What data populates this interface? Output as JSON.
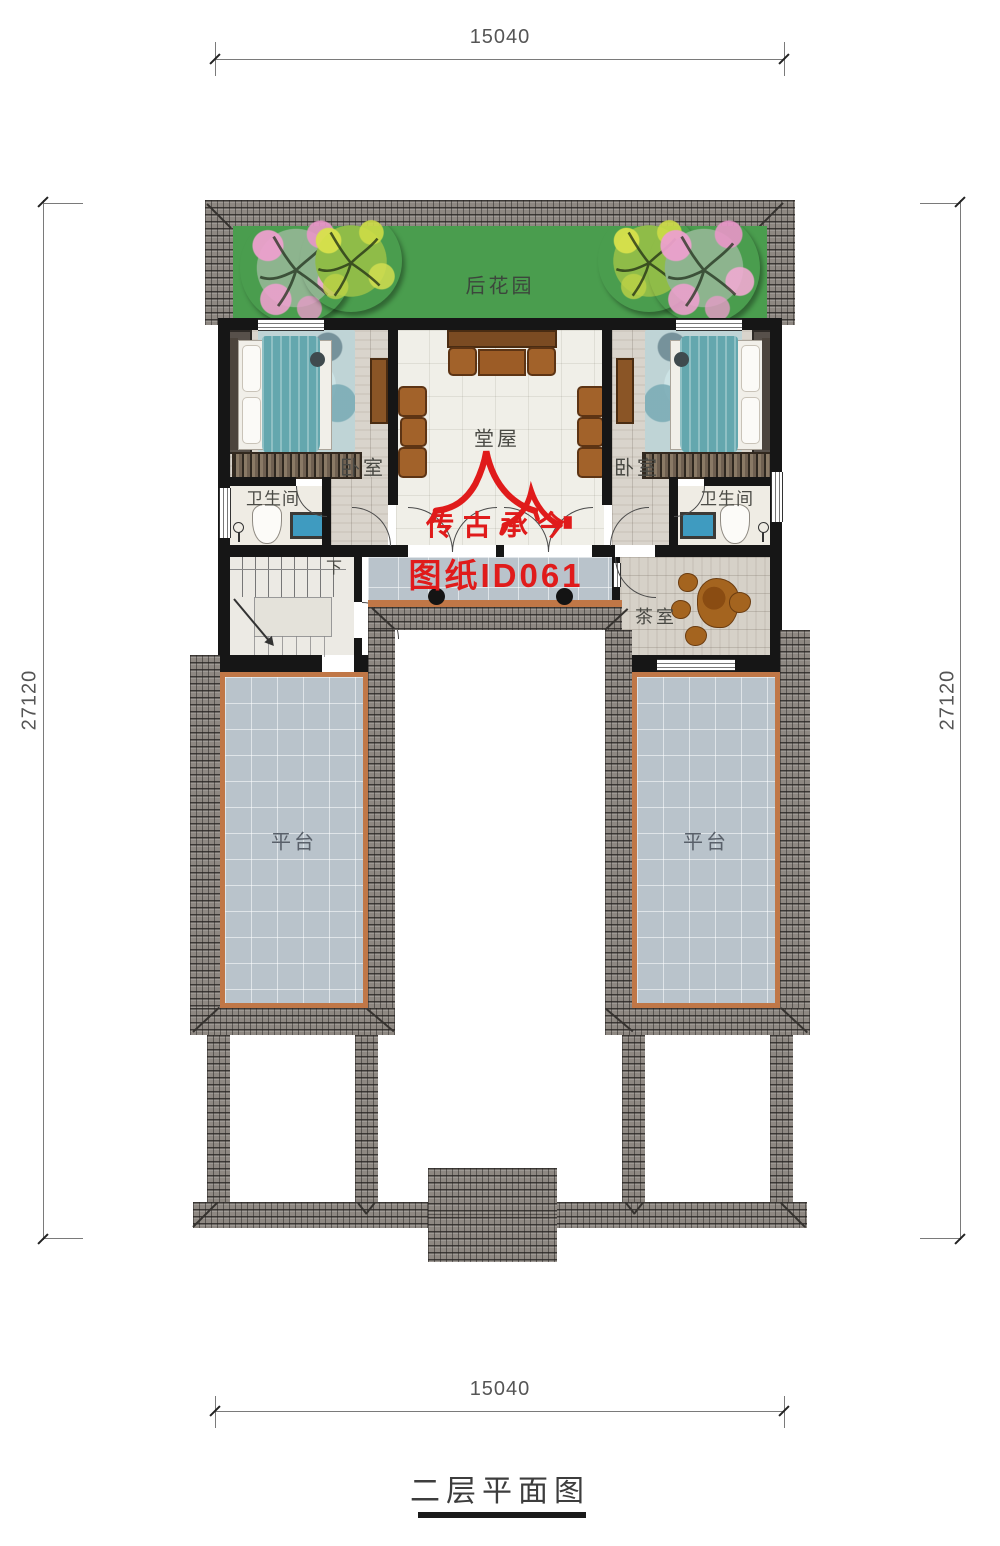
{
  "title": "二层平面图",
  "dimensions": {
    "top": "15040",
    "bottom": "15040",
    "left": "27120",
    "right": "27120"
  },
  "labels": {
    "garden": "后花园",
    "bedroom_left": "卧室",
    "bedroom_right": "卧室",
    "hall": "堂屋",
    "bathroom_left": "卫生间",
    "bathroom_right": "卫生间",
    "tea_room": "茶室",
    "terrace_left": "平台",
    "terrace_right": "平台",
    "stairs_down": "下"
  },
  "watermark": {
    "brand": "传古承今",
    "sheet_id": "图纸ID061"
  },
  "colors": {
    "roof_tile": "#8e8882",
    "garden_green": "#4a9d4e",
    "terrace_tile": "#b9c3cb",
    "trim_orange": "#c07747",
    "wall_black": "#161616",
    "watermark_red": "#e01b1b",
    "bed_teal": "#64a7ae",
    "furniture_brown": "#a2622a"
  }
}
